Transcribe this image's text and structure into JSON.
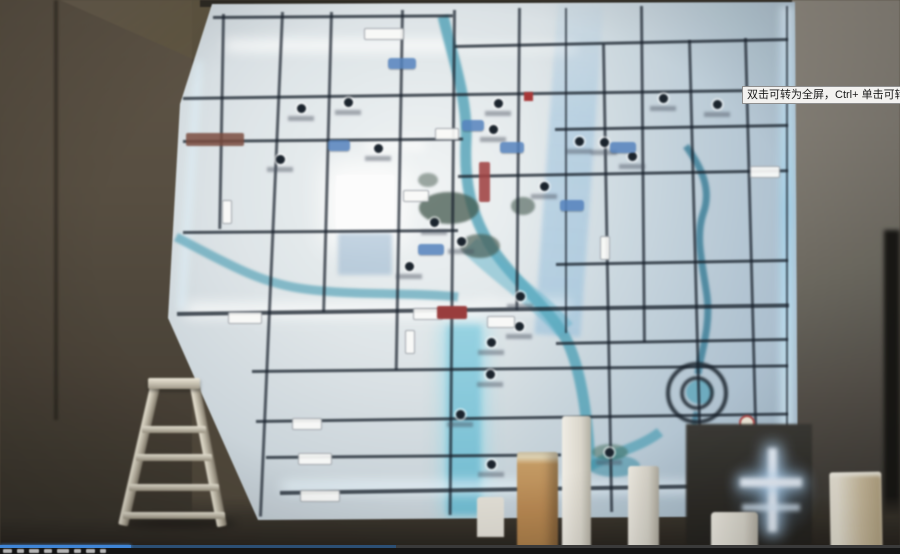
{
  "window": {
    "width": 900,
    "height": 554
  },
  "tooltip": {
    "text": "双击可转为全屏，Ctrl+ 单击可转为",
    "bg": "#f3f2f0",
    "border_color": "#8f8f8f",
    "text_color": "#1a1a1a"
  },
  "player": {
    "progress_percent": 14.5,
    "buffered_percent": 44,
    "progress_color": "#3f85d6",
    "buffer_color": "#2c4f74",
    "track_color": "#3a3a3a",
    "bar_bg": "#151515"
  },
  "scene": {
    "type": "video-frame-photo",
    "subject": "backlit district map wall in showroom with step ladder and foam pillars",
    "elements": [
      "illuminated-map-wall",
      "step-ladder",
      "foam-pillars",
      "led-glow-strips",
      "spiral-road-marker"
    ],
    "colors": {
      "wall_left": "#5e5343",
      "wall_right": "#837e74",
      "map_base": "#e0e7ea",
      "road_line": "#16202c",
      "river_teal": "#4aa2ba",
      "led_glow": "#e8f6ff",
      "park_green": "#41584c",
      "label_blue": "#5082c3",
      "label_red": "#a84040",
      "pillar_tan": "#b9854a",
      "pillar_cream": "#d9c9a6"
    }
  }
}
